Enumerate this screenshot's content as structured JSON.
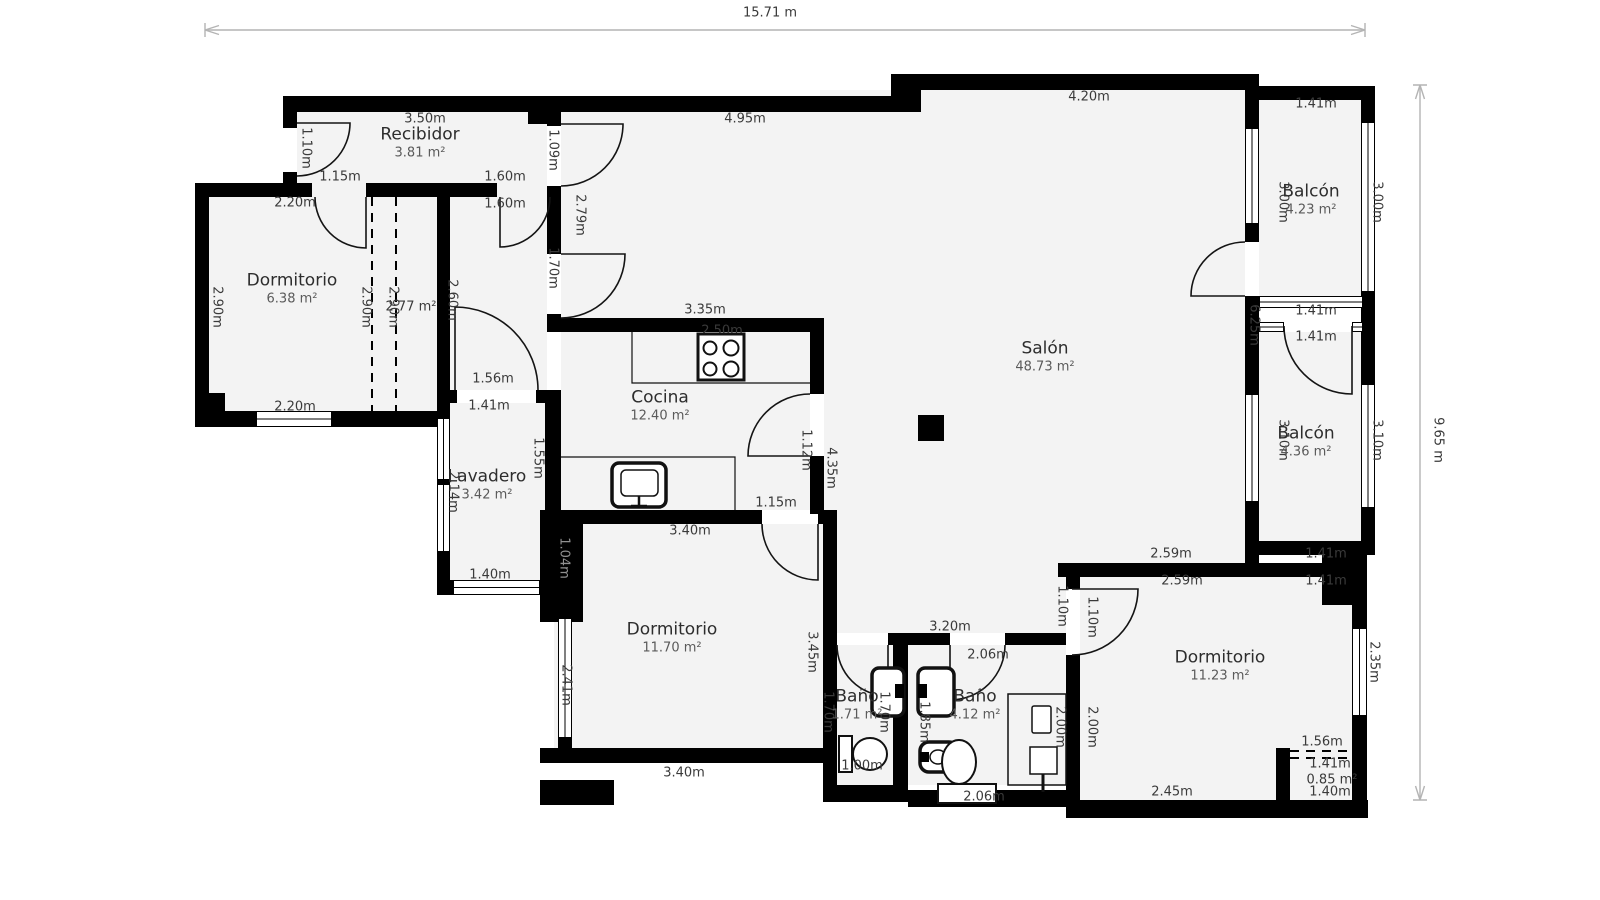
{
  "overall_dimensions": {
    "width_label": "15.71 m",
    "height_label": "9.65 m"
  },
  "rooms": [
    {
      "name": "Recibidor",
      "area": "3.81 m²",
      "x": 420,
      "y": 143
    },
    {
      "name": "Dormitorio",
      "area": "6.38 m²",
      "x": 292,
      "y": 289
    },
    {
      "name": "Cocina",
      "area": "12.40 m²",
      "x": 660,
      "y": 406
    },
    {
      "name": "Lavadero",
      "area": "3.42 m²",
      "x": 487,
      "y": 485
    },
    {
      "name": "Salón",
      "area": "48.73 m²",
      "x": 1045,
      "y": 357
    },
    {
      "name": "Balcón",
      "area": "4.23 m²",
      "x": 1311,
      "y": 200
    },
    {
      "name": "Balcón",
      "area": "4.36 m²",
      "x": 1306,
      "y": 442
    },
    {
      "name": "Dormitorio",
      "area": "11.70 m²",
      "x": 672,
      "y": 638
    },
    {
      "name": "Baño",
      "area": "1.71 m²",
      "x": 857,
      "y": 705
    },
    {
      "name": "Baño",
      "area": "4.12 m²",
      "x": 975,
      "y": 705
    },
    {
      "name": "Dormitorio",
      "area": "11.23 m²",
      "x": 1220,
      "y": 666
    }
  ],
  "dimension_labels": [
    {
      "text": "15.71 m",
      "x": 770,
      "y": 13,
      "rot": 0
    },
    {
      "text": "9.65 m",
      "x": 1438,
      "y": 440,
      "rot": 90
    },
    {
      "text": "3.50m",
      "x": 425,
      "y": 119,
      "rot": 0
    },
    {
      "text": "4.95m",
      "x": 745,
      "y": 119,
      "rot": 0
    },
    {
      "text": "4.20m",
      "x": 1089,
      "y": 97,
      "rot": 0
    },
    {
      "text": "1.41m",
      "x": 1316,
      "y": 104,
      "rot": 0
    },
    {
      "text": "1.10m",
      "x": 306,
      "y": 148,
      "rot": 90
    },
    {
      "text": "1.09m",
      "x": 553,
      "y": 150,
      "rot": 90
    },
    {
      "text": "1.15m",
      "x": 340,
      "y": 177,
      "rot": 0
    },
    {
      "text": "1.60m",
      "x": 505,
      "y": 177,
      "rot": 0
    },
    {
      "text": "2.20m",
      "x": 295,
      "y": 203,
      "rot": 0
    },
    {
      "text": "1.60m",
      "x": 505,
      "y": 204,
      "rot": 0
    },
    {
      "text": "2.79m",
      "x": 580,
      "y": 215,
      "rot": 90
    },
    {
      "text": "1.70m",
      "x": 553,
      "y": 268,
      "rot": 90
    },
    {
      "text": "2.90m",
      "x": 217,
      "y": 307,
      "rot": 90
    },
    {
      "text": "2.90m",
      "x": 366,
      "y": 307,
      "rot": 90
    },
    {
      "text": "2.90m",
      "x": 393,
      "y": 307,
      "rot": 90
    },
    {
      "text": "2.77 m²",
      "x": 411,
      "y": 307,
      "rot": 0
    },
    {
      "text": "2.60m",
      "x": 452,
      "y": 300,
      "rot": 90
    },
    {
      "text": "3.00m",
      "x": 1283,
      "y": 202,
      "rot": 90
    },
    {
      "text": "3.00m",
      "x": 1377,
      "y": 202,
      "rot": 90
    },
    {
      "text": "3.35m",
      "x": 705,
      "y": 310,
      "rot": 0
    },
    {
      "text": "2.50m",
      "x": 722,
      "y": 331,
      "rot": 0,
      "behind": true
    },
    {
      "text": "1.41m",
      "x": 1316,
      "y": 311,
      "rot": 0
    },
    {
      "text": "1.41m",
      "x": 1316,
      "y": 337,
      "rot": 0
    },
    {
      "text": "6.25m",
      "x": 1254,
      "y": 325,
      "rot": 90
    },
    {
      "text": "1.56m",
      "x": 493,
      "y": 379,
      "rot": 0
    },
    {
      "text": "1.41m",
      "x": 489,
      "y": 406,
      "rot": 0
    },
    {
      "text": "2.20m",
      "x": 295,
      "y": 407,
      "rot": 0
    },
    {
      "text": "1.12m",
      "x": 806,
      "y": 450,
      "rot": 90
    },
    {
      "text": "4.35m",
      "x": 831,
      "y": 468,
      "rot": 90
    },
    {
      "text": "3.10m",
      "x": 1283,
      "y": 440,
      "rot": 90
    },
    {
      "text": "3.10m",
      "x": 1377,
      "y": 440,
      "rot": 90
    },
    {
      "text": "1.55m",
      "x": 538,
      "y": 458,
      "rot": 90
    },
    {
      "text": "2.14m",
      "x": 453,
      "y": 492,
      "rot": 90
    },
    {
      "text": "2.15m",
      "x": 645,
      "y": 502,
      "rot": 0,
      "behind": true
    },
    {
      "text": "1.15m",
      "x": 776,
      "y": 503,
      "rot": 0
    },
    {
      "text": "3.40m",
      "x": 690,
      "y": 531,
      "rot": 0
    },
    {
      "text": "1.04m",
      "x": 564,
      "y": 558,
      "rot": 90,
      "onwall": true
    },
    {
      "text": "2.59m",
      "x": 1171,
      "y": 554,
      "rot": 0
    },
    {
      "text": "1.41m",
      "x": 1326,
      "y": 554,
      "rot": 0
    },
    {
      "text": "2.59m",
      "x": 1182,
      "y": 581,
      "rot": 0
    },
    {
      "text": "1.41m",
      "x": 1326,
      "y": 581,
      "rot": 0
    },
    {
      "text": "1.40m",
      "x": 490,
      "y": 575,
      "rot": 0
    },
    {
      "text": "1.10m",
      "x": 1062,
      "y": 606,
      "rot": 90
    },
    {
      "text": "1.10m",
      "x": 1092,
      "y": 617,
      "rot": 90
    },
    {
      "text": "3.20m",
      "x": 950,
      "y": 627,
      "rot": 0
    },
    {
      "text": "2.06m",
      "x": 988,
      "y": 655,
      "rot": 0
    },
    {
      "text": "3.45m",
      "x": 812,
      "y": 652,
      "rot": 90
    },
    {
      "text": "2.41m",
      "x": 566,
      "y": 685,
      "rot": 90
    },
    {
      "text": "1.70m",
      "x": 828,
      "y": 712,
      "rot": 90
    },
    {
      "text": "1.70m",
      "x": 884,
      "y": 712,
      "rot": 90
    },
    {
      "text": "1.85m",
      "x": 924,
      "y": 722,
      "rot": 90
    },
    {
      "text": "2.00m",
      "x": 1060,
      "y": 727,
      "rot": 90
    },
    {
      "text": "2.00m",
      "x": 1092,
      "y": 727,
      "rot": 90
    },
    {
      "text": "2.35m",
      "x": 1374,
      "y": 662,
      "rot": 90
    },
    {
      "text": "1.00m",
      "x": 862,
      "y": 766,
      "rot": 0
    },
    {
      "text": "3.40m",
      "x": 684,
      "y": 773,
      "rot": 0
    },
    {
      "text": "1.56m",
      "x": 1322,
      "y": 742,
      "rot": 0
    },
    {
      "text": "1.41m",
      "x": 1330,
      "y": 764,
      "rot": 0
    },
    {
      "text": "0.85 m²",
      "x": 1332,
      "y": 780,
      "rot": 0
    },
    {
      "text": "2.06m",
      "x": 984,
      "y": 797,
      "rot": 0
    },
    {
      "text": "2.45m",
      "x": 1172,
      "y": 792,
      "rot": 0
    },
    {
      "text": "1.40m",
      "x": 1330,
      "y": 792,
      "rot": 0
    }
  ]
}
